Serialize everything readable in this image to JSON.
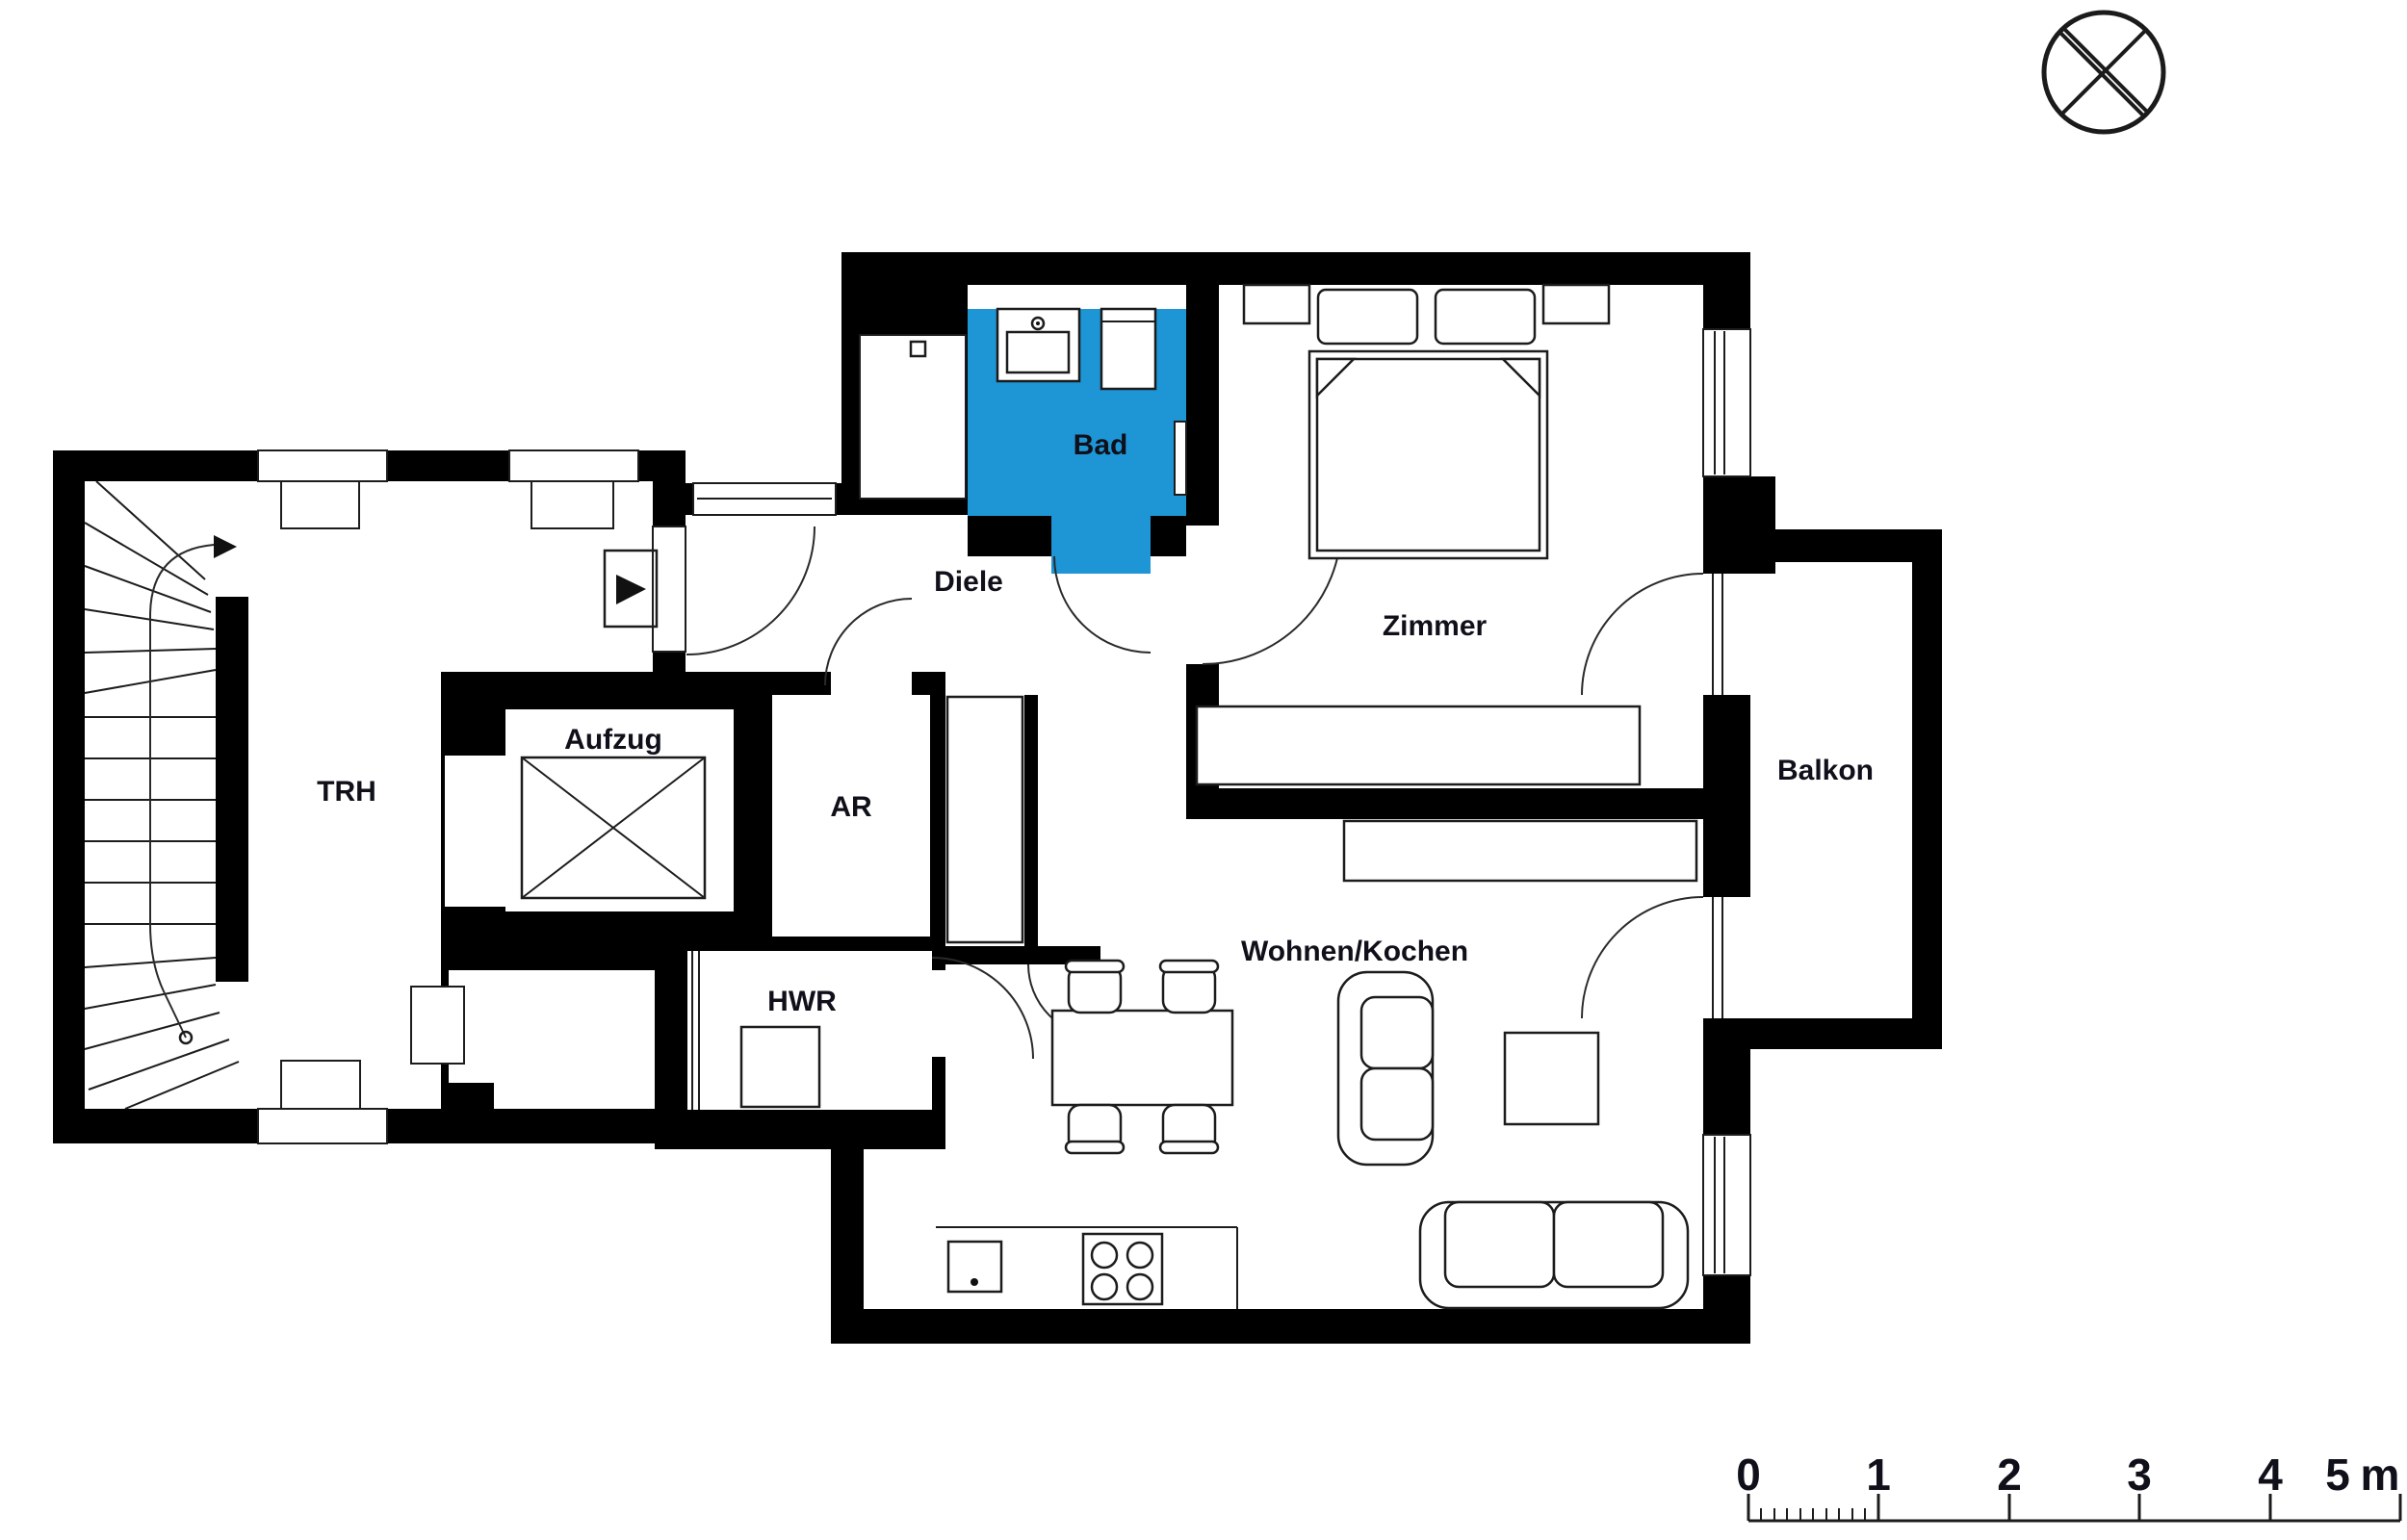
{
  "rooms": {
    "trh": "TRH",
    "aufzug": "Aufzug",
    "ar": "AR",
    "hwr": "HWR",
    "diele": "Diele",
    "bad": "Bad",
    "zimmer": "Zimmer",
    "wohnen_kochen": "Wohnen/Kochen",
    "balkon": "Balkon"
  },
  "scale_bar": {
    "numbers": [
      "0",
      "1",
      "2",
      "3",
      "4",
      "5"
    ],
    "unit": "m"
  },
  "colors": {
    "bathroom_fill": "#1E95D4",
    "wall": "#000000",
    "label": "#10101A"
  },
  "icons": {
    "compass": "compass-crosshair-icon",
    "entrance": "entrance-arrow-icon"
  }
}
